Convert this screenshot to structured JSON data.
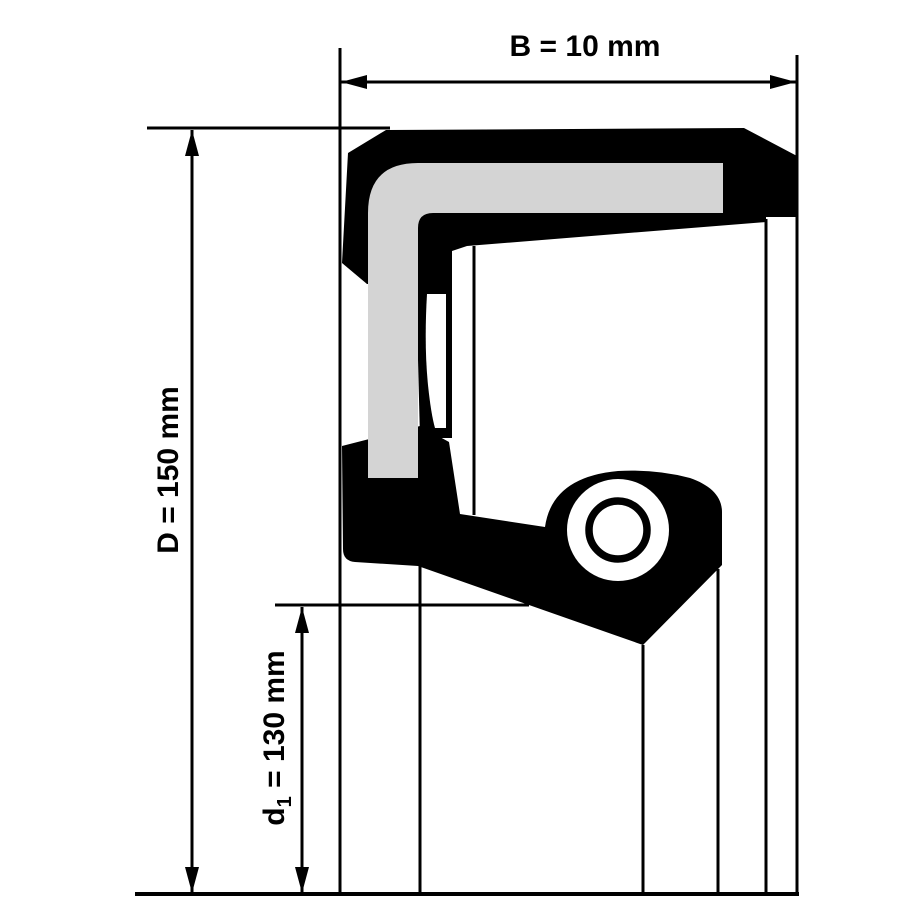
{
  "diagram": {
    "description": "shaft-seal cross-section drawing",
    "colors": {
      "line": "#000000",
      "insert": "#d4d4d4",
      "background": "#ffffff"
    },
    "dimensions": {
      "width": {
        "label": "B = 10 mm"
      },
      "outer_diameter": {
        "label": "D = 150 mm"
      },
      "inner_diameter": {
        "prefix": "d",
        "subscript": "1",
        "suffix": " = 130 mm"
      }
    }
  }
}
